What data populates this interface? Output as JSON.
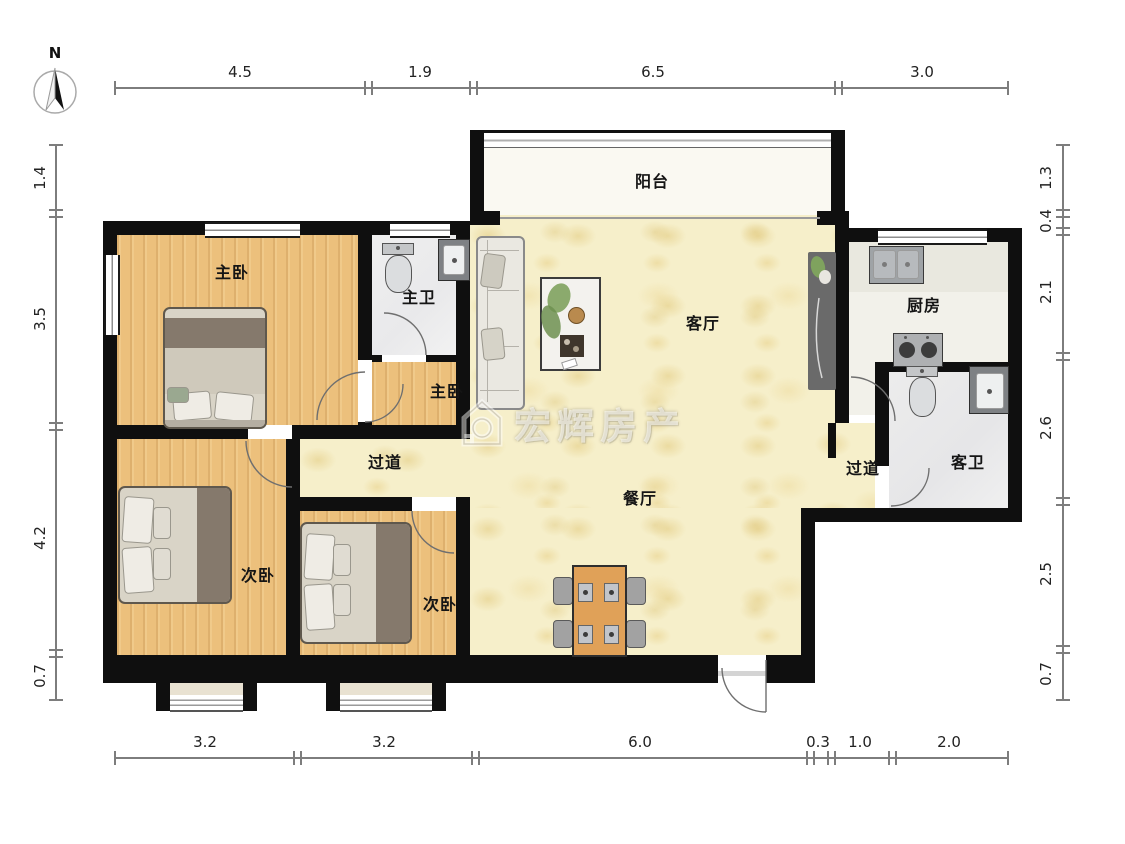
{
  "compass": {
    "label": "N"
  },
  "watermark": {
    "text": "宏辉房产",
    "logo": "house-logo"
  },
  "rooms": {
    "balcony": {
      "label": "阳台"
    },
    "master_bedroom": {
      "label": "主卧"
    },
    "master_bathroom": {
      "label": "主卫"
    },
    "master_vestibule": {
      "label": "主卧"
    },
    "living_room": {
      "label": "客厅"
    },
    "kitchen": {
      "label": "厨房"
    },
    "hallway_left": {
      "label": "过道"
    },
    "hallway_right": {
      "label": "过道"
    },
    "guest_bathroom": {
      "label": "客卫"
    },
    "dining_room": {
      "label": "餐厅"
    },
    "bedroom_2": {
      "label": "次卧"
    },
    "bedroom_3": {
      "label": "次卧"
    }
  },
  "dimensions": {
    "top": [
      "4.5",
      "1.9",
      "6.5",
      "3.0"
    ],
    "bottom": [
      "3.2",
      "3.2",
      "6.0",
      "0.3",
      "1.0",
      "2.0"
    ],
    "left": [
      "1.4",
      "3.5",
      "4.2",
      "0.7"
    ],
    "right": [
      "1.3",
      "0.4",
      "2.1",
      "2.6",
      "2.5",
      "0.7"
    ]
  },
  "colors": {
    "wall": "#0f0f0f",
    "wood_floor": "#ecc07c",
    "living_floor": "#f6efca",
    "bath_floor": "#ededed",
    "kitchen_floor": "#f2f1ea",
    "balcony_floor": "#faf9f2",
    "bay_window_fill": "#e9e2d2",
    "dimension_line": "#7d7d7d"
  }
}
